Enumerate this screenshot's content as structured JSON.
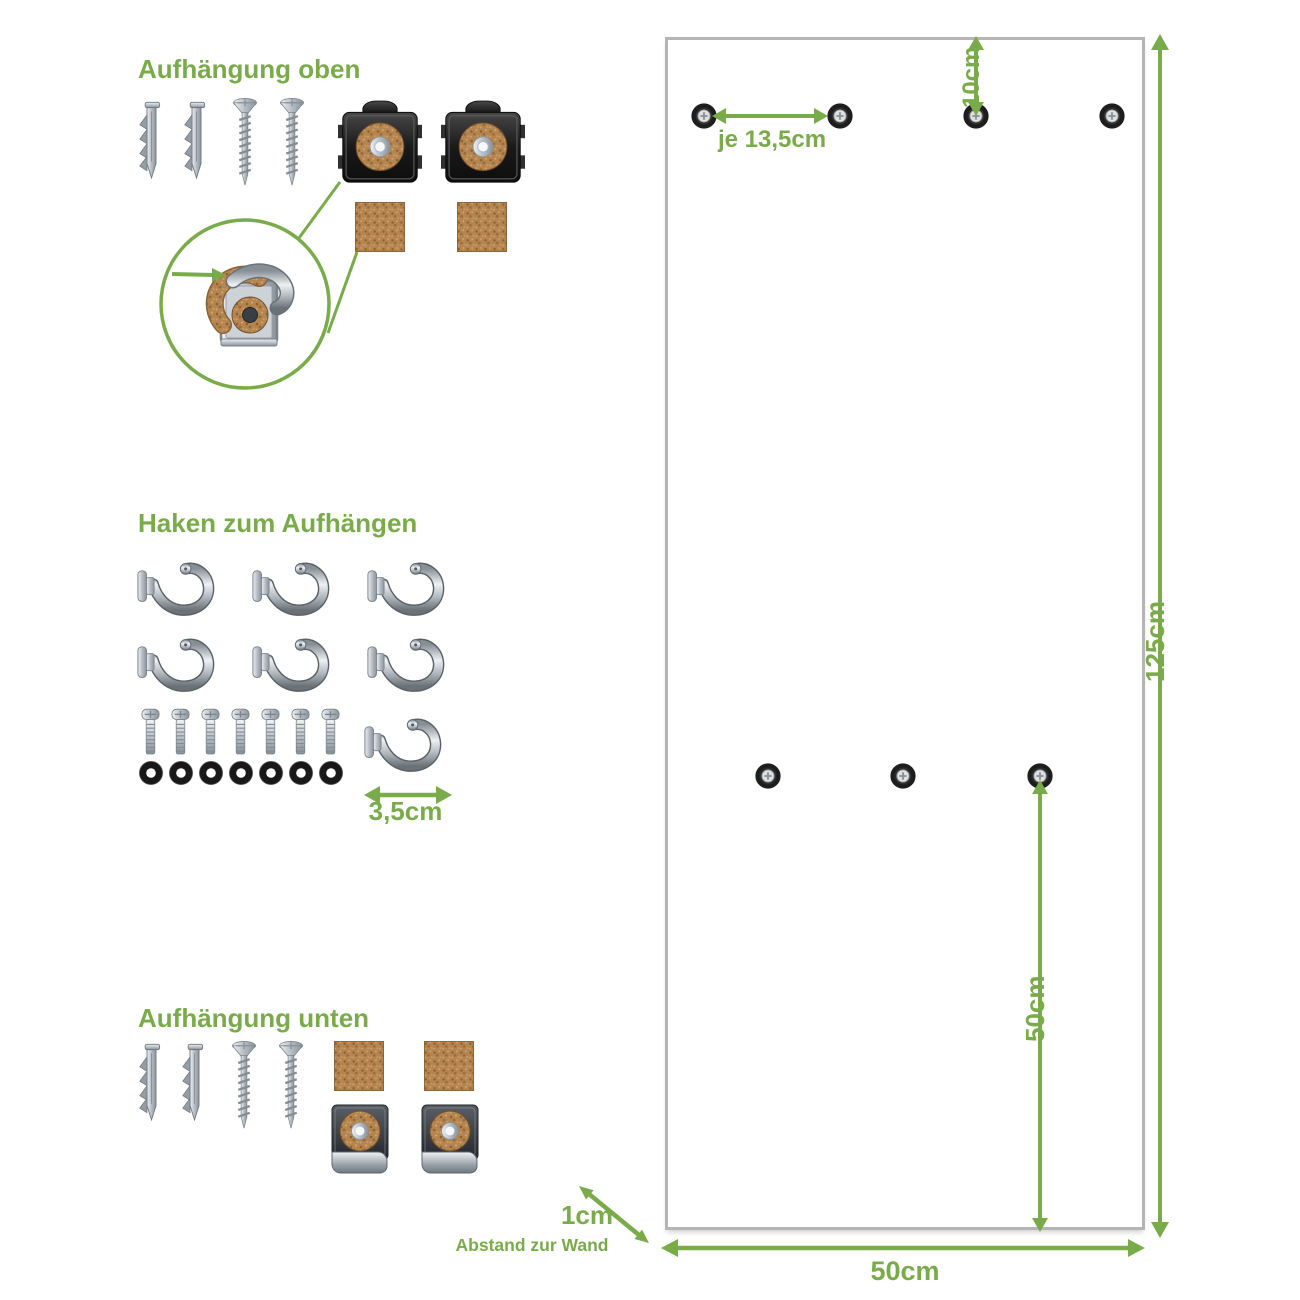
{
  "colors": {
    "accent_green": "#7aab4a",
    "panel_border": "#b5b5b5",
    "cork_brown": "#b5854f",
    "ring_black": "#1a1a1a",
    "metal_silver": "#b6bdc4",
    "metal_dark": "#2a2a2a"
  },
  "sections": {
    "top_mount": {
      "title": "Aufhängung oben",
      "parts": [
        "wall-plug",
        "wall-plug",
        "wood-screw",
        "wood-screw",
        "mounting-clip-top",
        "mounting-clip-top",
        "cork-pad",
        "cork-pad"
      ],
      "detail": "clip-with-cork-strip-closeup"
    },
    "hooks": {
      "title": "Haken zum Aufhängen",
      "hook_count": 7,
      "bolt_count": 7,
      "ring_count": 7,
      "hook_width_label": "3,5cm"
    },
    "bottom_mount": {
      "title": "Aufhängung unten",
      "parts": [
        "wall-plug",
        "wall-plug",
        "wood-screw",
        "wood-screw",
        "cork-pad",
        "cork-pad",
        "mounting-clip-bottom",
        "mounting-clip-bottom"
      ]
    }
  },
  "panel": {
    "height_label": "125cm",
    "width_label": "50cm",
    "top_hole_offset_label": "10cm",
    "top_hole_spacing_label": "je 13,5cm",
    "middle_hole_height_label": "50cm",
    "wall_gap_value": "1cm",
    "wall_gap_caption": "Abstand zur Wand",
    "top_hole_count": 4,
    "middle_hole_count": 3
  }
}
